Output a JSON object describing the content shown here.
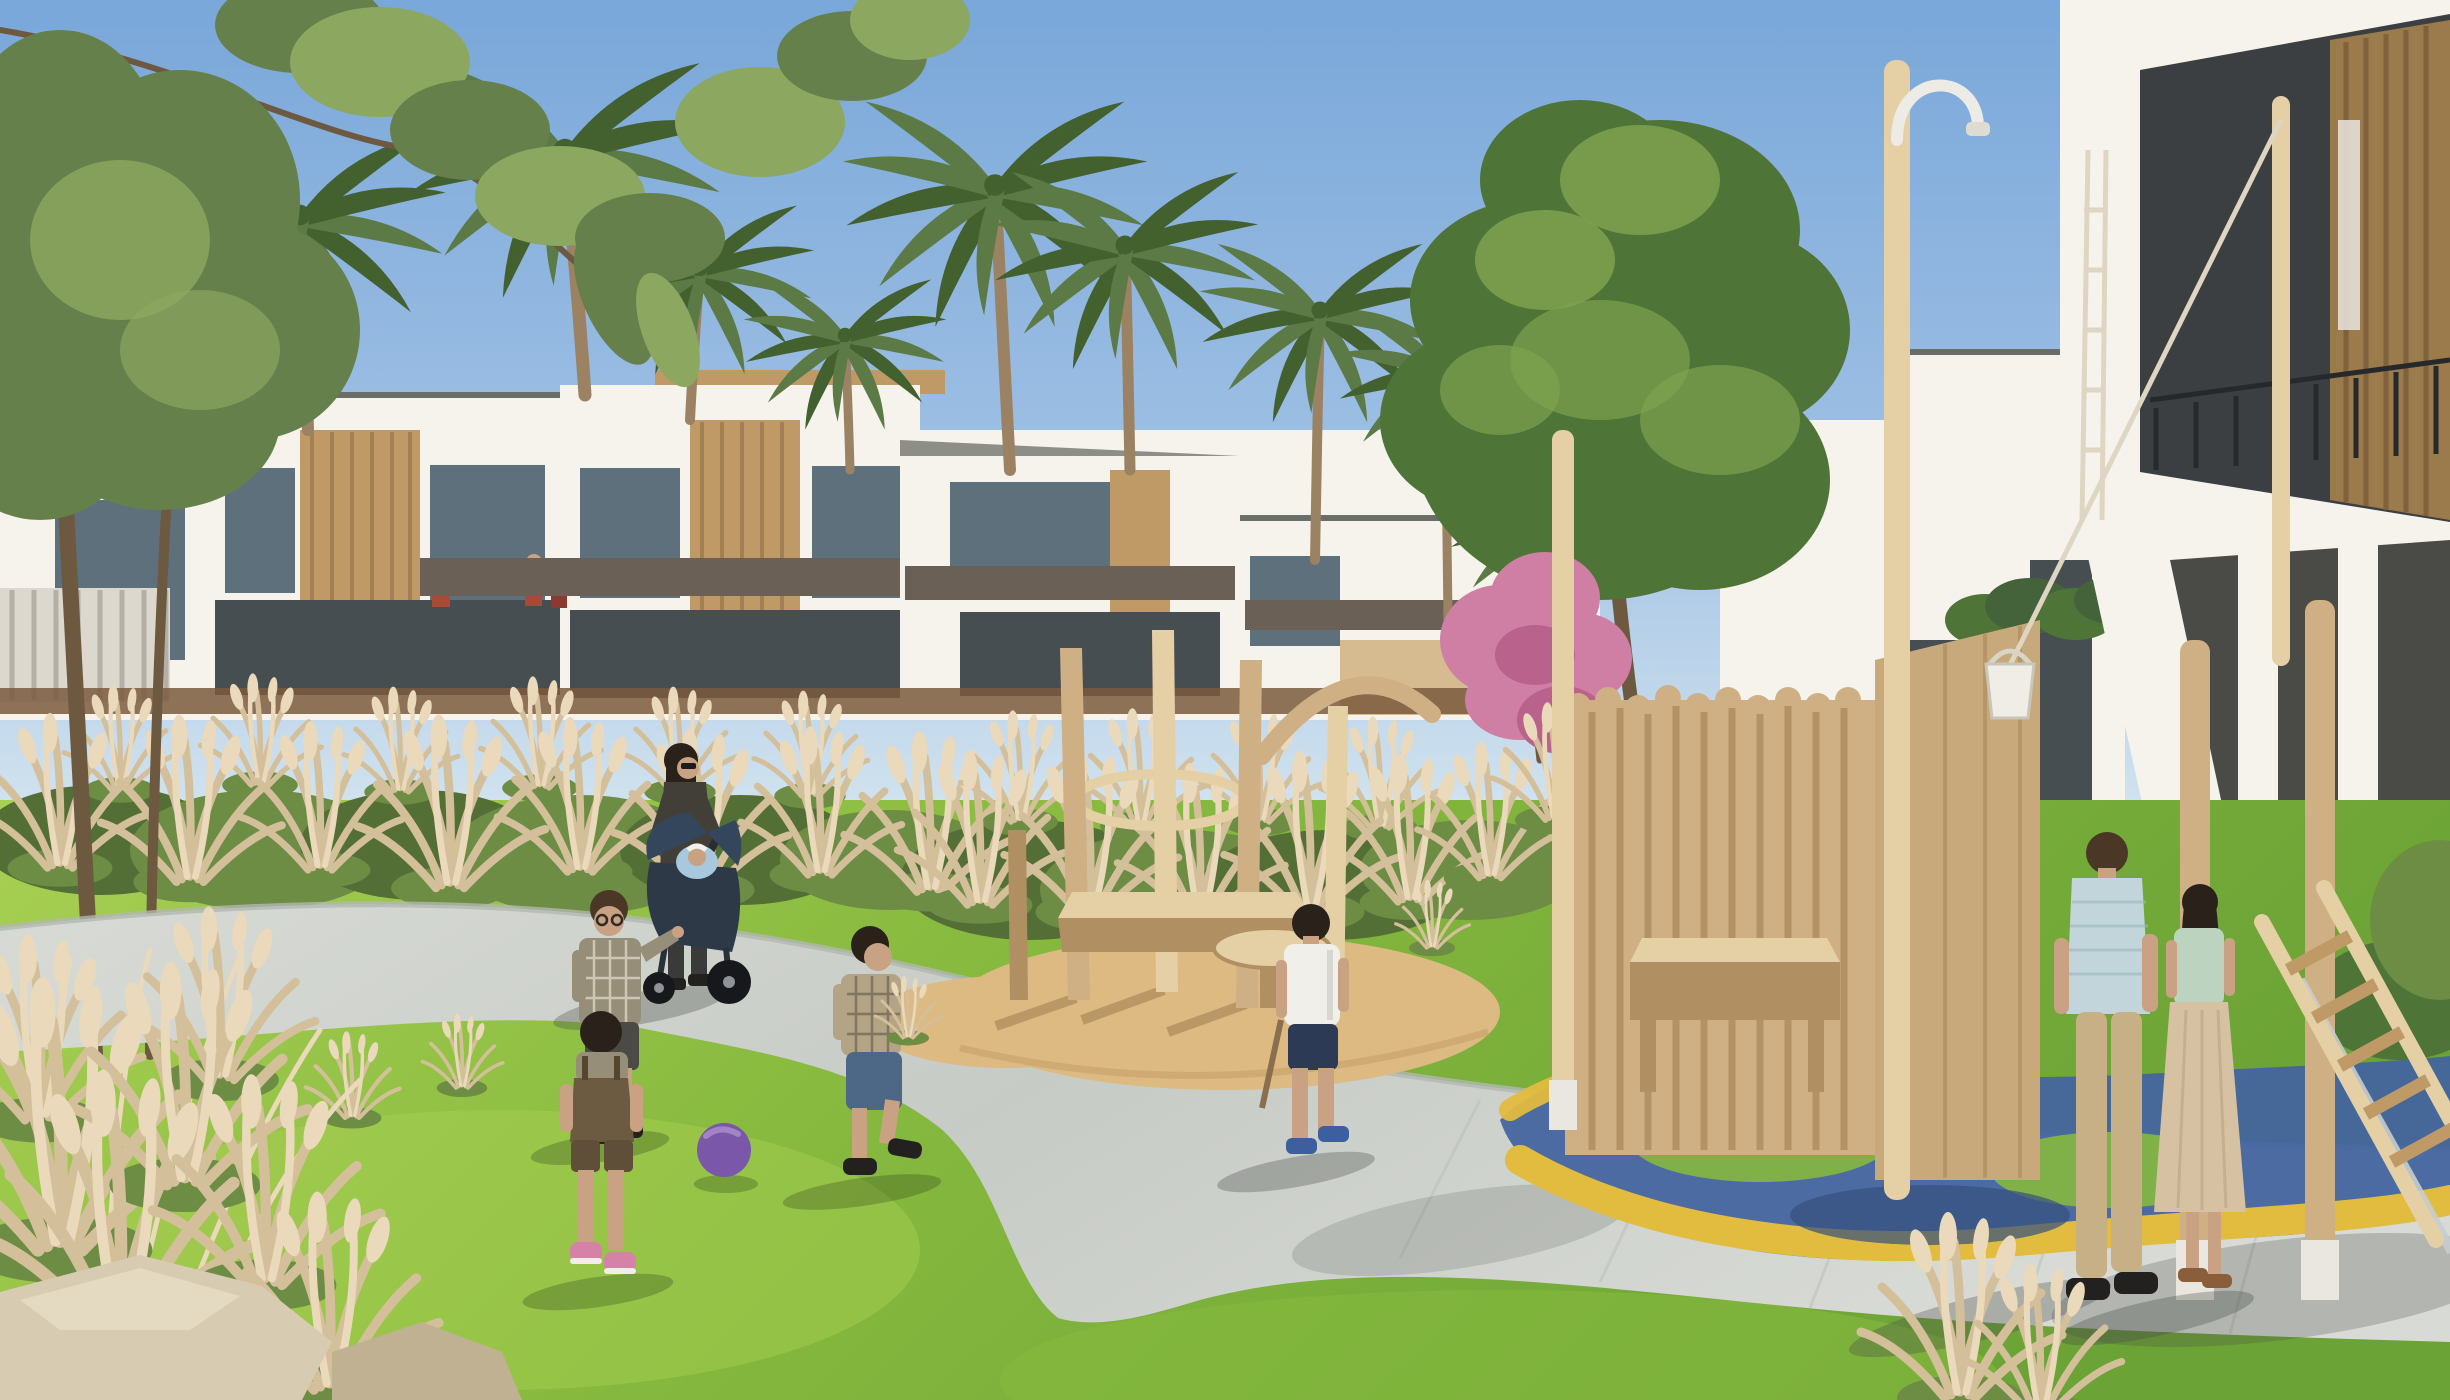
{
  "scene": {
    "type": "architectural_rendering",
    "setting": "Sunny residential community park: white modern townhouses with wood accents and palm trees behind an ornamental-grass hedge; children play ball on a bright lawn beside a curving gray footpath; a natural-wood playground on a sand circle sits in the center and a wooden play fort with blue and yellow rubber surfacing stands at the right below a large white villa",
    "lighting": "clear blue sky, strong daylight, shadows cast to lower-left"
  },
  "palette": {
    "sky_top": "#79a7d9",
    "sky_mid": "#9fc0e4",
    "sky_horizon": "#d9e8f0",
    "white_wall": "#f5f3ec",
    "wall_shade": "#e6e0d4",
    "roof_cap": "#6a6d68",
    "wood_accent": "#c09a66",
    "wood_dark": "#9b7a4c",
    "window_dark": "#474e52",
    "window_blue": "#5e707c",
    "band_dark": "#6b6055",
    "band_brown": "#7a5a3e",
    "fence_light": "#dcd8cd",
    "fence_line": "#b4b0a5",
    "palm_green": "#5c7a45",
    "palm_dark": "#43602f",
    "palm_trunk": "#9b8262",
    "tree_green": "#4f7438",
    "tree_light": "#7ea24f",
    "tree_olive": "#65804a",
    "tree_olive_light": "#8ca75f",
    "branch_brown": "#6d5840",
    "pink_bloom": "#cf7fa4",
    "pink_deep": "#b9638c",
    "hedge_green": "#6d8c44",
    "hedge_dark": "#546f36",
    "plume": "#d4bf9b",
    "plume_light": "#ead9ba",
    "lawn_light": "#a8d053",
    "lawn_mid": "#86b93e",
    "lawn_dark": "#6ca336",
    "path_light": "#d8dbd5",
    "path_mid": "#c7cbc6",
    "curb": "#b2b8b2",
    "sand": "#dcba82",
    "sand_dark": "#c6a067",
    "pole_wood": "#cfb084",
    "pole_dark": "#b08f62",
    "pole_light": "#e5cfa5",
    "panel_wood": "#c7a97c",
    "play_blue": "#44659f",
    "play_yellow": "#e2bc3f",
    "rock": "#d7cbb1",
    "rock_dark": "#c0b192",
    "ball_purple": "#7a57a8",
    "ball_light": "#a184c8",
    "skin": "#c9a183",
    "hair_dark": "#2a211b",
    "hair_brown": "#4a3726",
    "stroller_body": "#2e3947",
    "stroller_seat": "#a8c8de",
    "wheel_dark": "#16181b",
    "jacket_dark": "#423f38",
    "plaid_gray": "#968e79",
    "plaid_tan": "#b2a485",
    "check_light": "#e9e4d6",
    "shorts_dark": "#4b4a44",
    "jeans": "#4d6787",
    "navy": "#2d3a55",
    "white_shirt": "#f0efe9",
    "man_top": "#c2d5da",
    "khaki": "#c8b086",
    "mint": "#bcd4bf",
    "skirt_beige": "#d7c1a3",
    "red_shirt": "#a84a35",
    "maroon": "#8a3a2e",
    "shoe_pink": "#d581a8",
    "shoe_dark": "#23211f",
    "shoe_blue": "#3e5f9e",
    "rope": "#ded6c2",
    "bucket": "#efede6",
    "metal": "#c8cdd0",
    "shadow_grass": "rgba(45,70,25,0.30)",
    "shadow_path": "rgba(70,75,70,0.32)"
  },
  "elements": {
    "background": [
      "clear blue sky",
      "row of white two-storey townhouses with wood-slat accents, dark balcony bands and glass fronts",
      "large white villa facade at right with recessed dark balconies and wooden slat screens",
      "nine date palms rising above the rooflines",
      "large round green tree right of center",
      "pink flowering tree beside it",
      "tree with hanging leafy branches across the top-left corner",
      "light slatted fence at far left"
    ],
    "midground": [
      "continuous ornamental-grass hedge with tan plumes",
      "brown base wall behind the hedge",
      "natural-wood playground: leaning poles, basket ring, bench slab and round stool on a sand circle",
      "wooden play fort with rounded slat fence, solid panel, shower arch pole, rope with hanging bucket",
      "diagonal wooden ladder at far right",
      "blue rubber safety surface with yellow bands and grass mounds"
    ],
    "foreground": [
      "bright green lawn",
      "curving light-gray paved footpath from left edge to bottom right",
      "pampas grass clumps at lower left and bottom right",
      "beige rocks in the lower-left corner",
      "purple play ball on the lawn"
    ],
    "people": [
      {
        "name": "woman-with-stroller",
        "details": "dark jacket, sunglasses, black hair, pushing a dark stroller with a baby in a light-blue seat"
      },
      {
        "name": "boy-with-glasses",
        "details": "gray plaid shirt, dark shorts, black sneakers, arm raised"
      },
      {
        "name": "toddler-in-overalls",
        "details": "brown overalls, pink sneakers, dark hair, seen from behind"
      },
      {
        "name": "boy-in-plaid",
        "details": "tan plaid shirt, denim capri jeans, walking right"
      },
      {
        "name": "boy-in-white-tshirt",
        "details": "white t-shirt, navy shorts, holding a stick, walking toward the playground"
      },
      {
        "name": "man-in-knit-polo",
        "details": "light-blue knit polo, khaki trousers, dark shoes, back to viewer at the fort"
      },
      {
        "name": "girl-in-mint-top",
        "details": "mint sleeveless top, long beige skirt, long dark hair, sandals"
      },
      {
        "name": "balcony-residents",
        "details": "small figures in red tops standing on townhouse balconies"
      }
    ],
    "ball_color": "purple"
  }
}
